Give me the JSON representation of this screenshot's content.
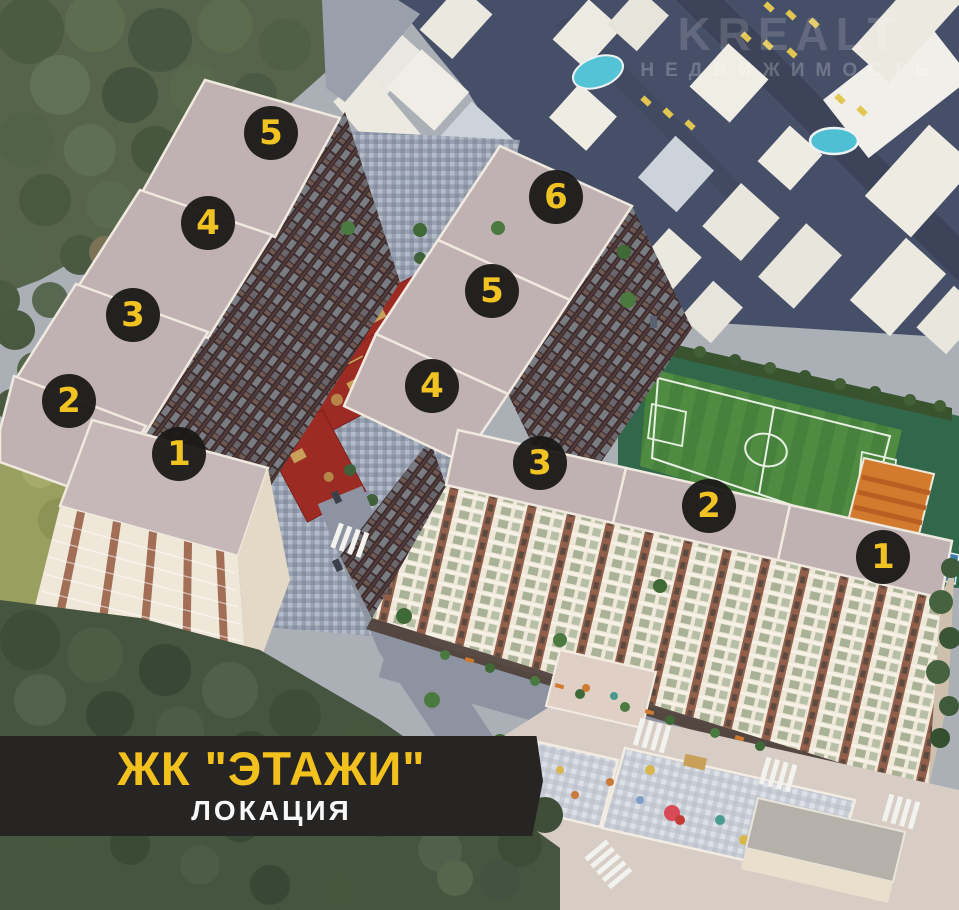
{
  "image": {
    "width": 959,
    "height": 910,
    "description_visible_scene": "aerial 3D render of residential complex with two multi-section apartment buildings, numbered section markers, courtyard playgrounds, football field, surrounding low-rise district and forest"
  },
  "banner": {
    "title": "ЖК \"ЭТАЖИ\"",
    "subtitle": "ЛОКАЦИЯ",
    "bg": "#262523",
    "title_color": "#f2c11d",
    "subtitle_color": "#f8f8f8"
  },
  "watermark": {
    "line1": "KREALT",
    "line2": "НЕДВИЖИМОСТЬ"
  },
  "marker_style": {
    "bg": "rgba(26,25,23,0.95)",
    "color": "#f0c323",
    "radius": 27,
    "font_size": 34
  },
  "buildings": {
    "left": {
      "sections": [
        {
          "label": "1",
          "x": 179,
          "y": 454
        },
        {
          "label": "2",
          "x": 69,
          "y": 401
        },
        {
          "label": "3",
          "x": 133,
          "y": 315
        },
        {
          "label": "4",
          "x": 208,
          "y": 223
        },
        {
          "label": "5",
          "x": 271,
          "y": 133
        }
      ]
    },
    "right": {
      "sections": [
        {
          "label": "1",
          "x": 883,
          "y": 557
        },
        {
          "label": "2",
          "x": 709,
          "y": 506
        },
        {
          "label": "3",
          "x": 540,
          "y": 463
        },
        {
          "label": "4",
          "x": 432,
          "y": 386
        },
        {
          "label": "5",
          "x": 492,
          "y": 291
        },
        {
          "label": "6",
          "x": 556,
          "y": 197
        }
      ]
    }
  },
  "palette": {
    "forest": "#55644a",
    "forest_dark": "#46553f",
    "grass": "#99a05f",
    "district_ground": "#464f68",
    "district_road": "#3d4459",
    "district_building": "#eceae4",
    "road": "#8d93a0",
    "roof": "#c0b1b2",
    "parapet": "#efe9df",
    "facade_dark": "#3e2c2f",
    "facade_cream": "#efe7d8",
    "brick": "#92604a",
    "courtyard_paving": "#98a1b0",
    "playground_red": "#9c2b24",
    "field_green": "#47823c",
    "sport_teal": "#31684c",
    "court_orange": "#d27a2e",
    "court_blue": "#3f7fae",
    "pool_blue": "#55c3d6",
    "car_yellow": "#e2c652",
    "banner_bg": "#262523",
    "accent_yellow": "#f2c11d"
  }
}
